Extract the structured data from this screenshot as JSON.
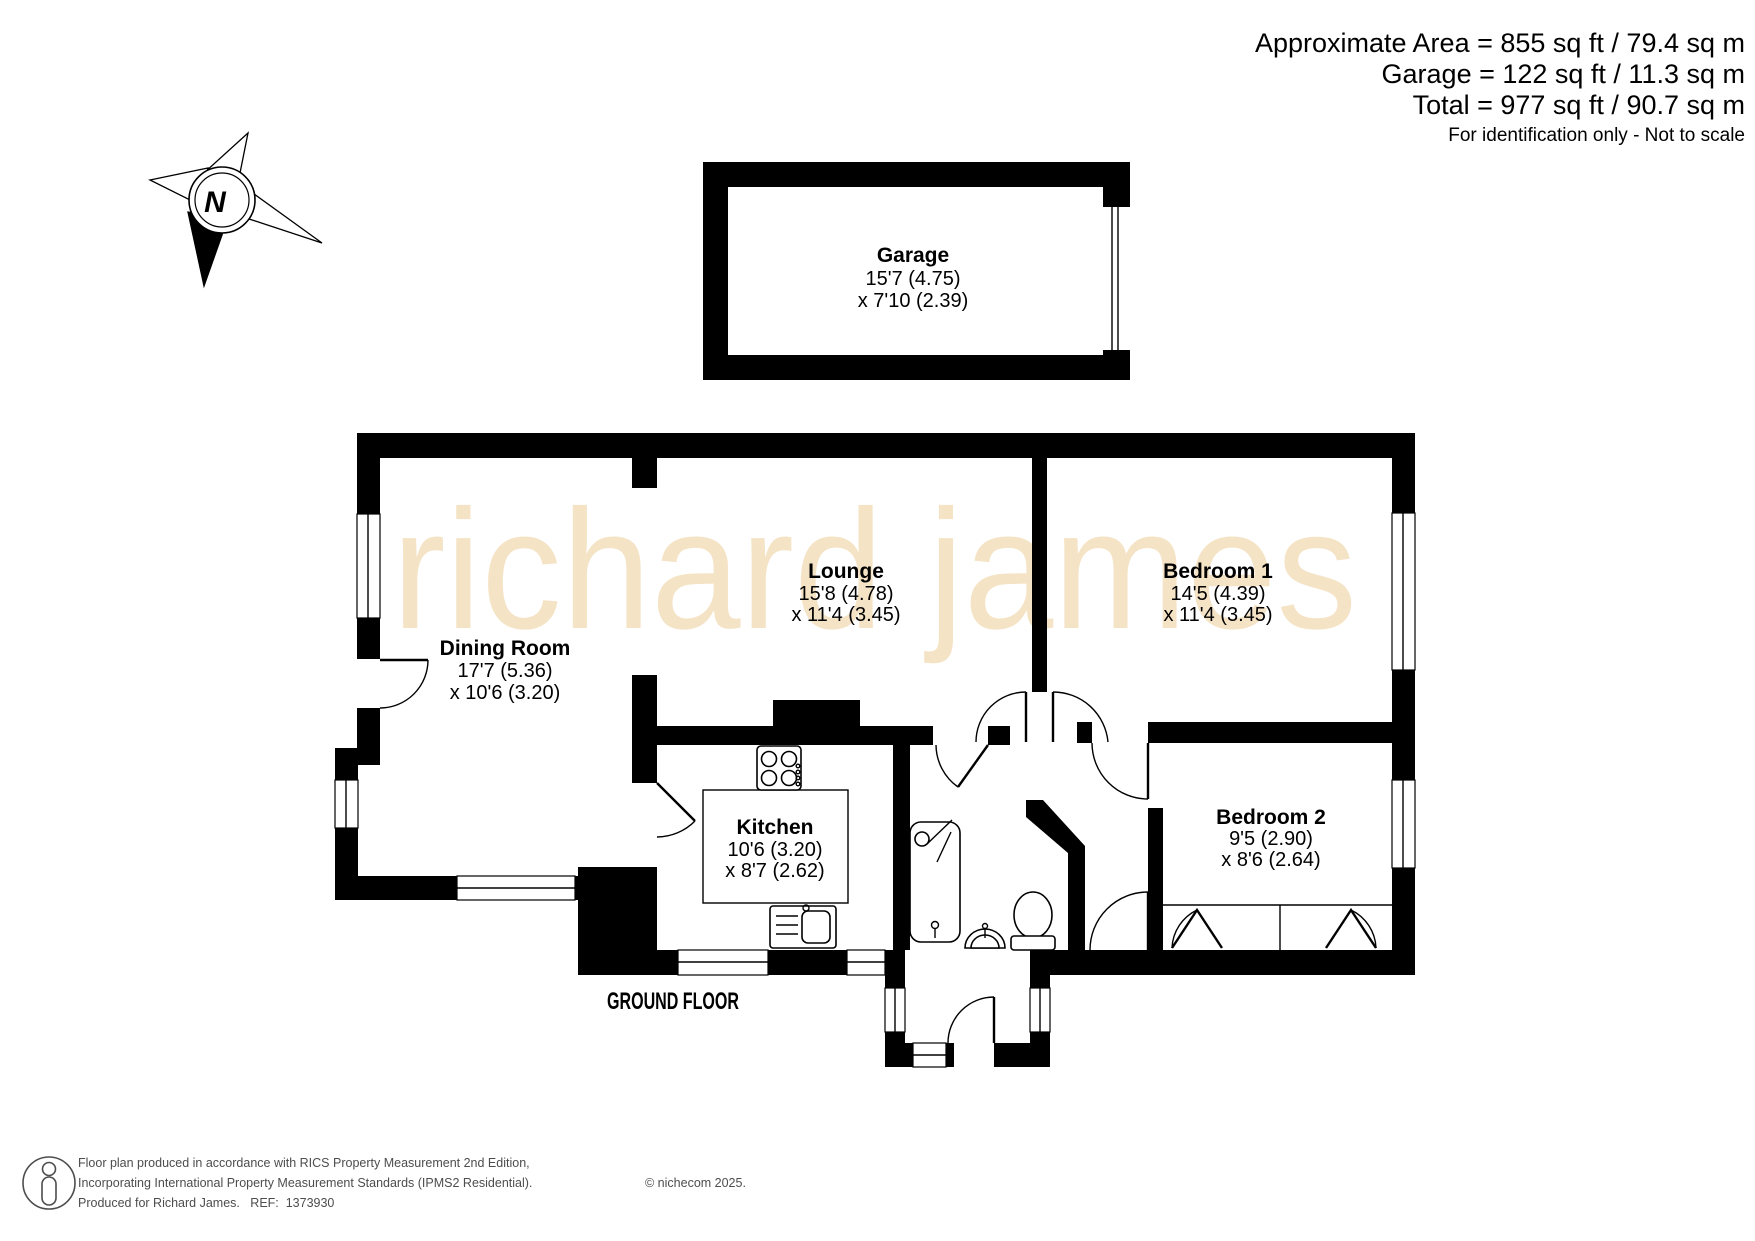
{
  "header": {
    "area_line": "Approximate Area = 855 sq ft / 79.4 sq m",
    "garage_line": "Garage = 122 sq ft / 11.3 sq m",
    "total_line": "Total = 977 sq ft / 90.7 sq m",
    "disclaimer": "For identification only - Not to scale"
  },
  "compass": {
    "north_label": "N"
  },
  "watermark": "richard james",
  "floor_label": "GROUND FLOOR",
  "rooms": {
    "garage": {
      "name": "Garage",
      "dim1": "15'7 (4.75)",
      "dim2": "x 7'10 (2.39)"
    },
    "dining": {
      "name": "Dining Room",
      "dim1": "17'7 (5.36)",
      "dim2": "x 10'6 (3.20)"
    },
    "lounge": {
      "name": "Lounge",
      "dim1": "15'8 (4.78)",
      "dim2": "x 11'4 (3.45)"
    },
    "bedroom1": {
      "name": "Bedroom 1",
      "dim1": "14'5 (4.39)",
      "dim2": "x 11'4 (3.45)"
    },
    "kitchen": {
      "name": "Kitchen",
      "dim1": "10'6 (3.20)",
      "dim2": "x 8'7 (2.62)"
    },
    "bedroom2": {
      "name": "Bedroom 2",
      "dim1": "9'5 (2.90)",
      "dim2": "x 8'6 (2.64)"
    }
  },
  "footer": {
    "line1": "Floor plan produced in accordance with RICS Property Measurement 2nd Edition,",
    "line2": "Incorporating International Property Measurement Standards (IPMS2 Residential).",
    "copyright": "© nichecom 2025.",
    "line3": "Produced for Richard James.   REF:  1373930"
  },
  "colors": {
    "walls": "#000000",
    "watermark": "#f5e3c5",
    "footer_text": "#4d4d4d"
  }
}
